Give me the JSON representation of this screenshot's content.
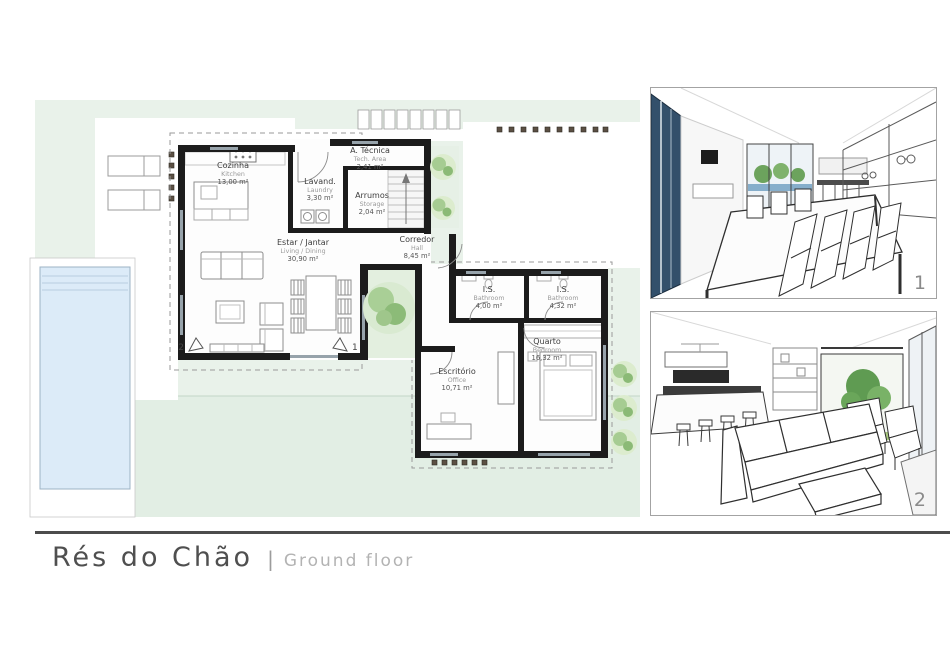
{
  "footer": {
    "title_pt": "Rés do Chão",
    "separator": "|",
    "title_en": "Ground floor"
  },
  "plan": {
    "rooms": [
      {
        "id": "kitchen",
        "name_pt": "Cozinha",
        "name_en": "Kitchen",
        "area": "13,00 m²"
      },
      {
        "id": "laundry",
        "name_pt": "Lavand.",
        "name_en": "Laundry",
        "area": "3,30 m²"
      },
      {
        "id": "tech",
        "name_pt": "A. Técnica",
        "name_en": "Tech. Area",
        "area": "2,41 m²"
      },
      {
        "id": "storage",
        "name_pt": "Arrumos",
        "name_en": "Storage",
        "area": "2,04 m²"
      },
      {
        "id": "hall",
        "name_pt": "Corredor",
        "name_en": "Hall",
        "area": "8,45 m²"
      },
      {
        "id": "living",
        "name_pt": "Estar / Jantar",
        "name_en": "Living / Dining",
        "area": "30,90 m²"
      },
      {
        "id": "bath1",
        "name_pt": "I.S.",
        "name_en": "Bathroom",
        "area": "4,00 m²"
      },
      {
        "id": "bath2",
        "name_pt": "I.S.",
        "name_en": "Bathroom",
        "area": "4,32 m²"
      },
      {
        "id": "bedroom",
        "name_pt": "Quarto",
        "name_en": "Bedroom",
        "area": "16,32 m²"
      },
      {
        "id": "office",
        "name_pt": "Escritório",
        "name_en": "Office",
        "area": "10,71 m²"
      }
    ],
    "markers": [
      {
        "label": "2"
      },
      {
        "label": "1"
      }
    ]
  },
  "renders": [
    {
      "label": "1",
      "caption": "dining room interior render"
    },
    {
      "label": "2",
      "caption": "living room interior render"
    }
  ],
  "colors": {
    "site_green": "#e9f2ea",
    "lawn_green": "#e2eee4",
    "pool_blue": "#dcebf8",
    "wall_black": "#1c1c1c",
    "tree_green": "#a6cc92",
    "footer_line": "#4c4c4c"
  }
}
